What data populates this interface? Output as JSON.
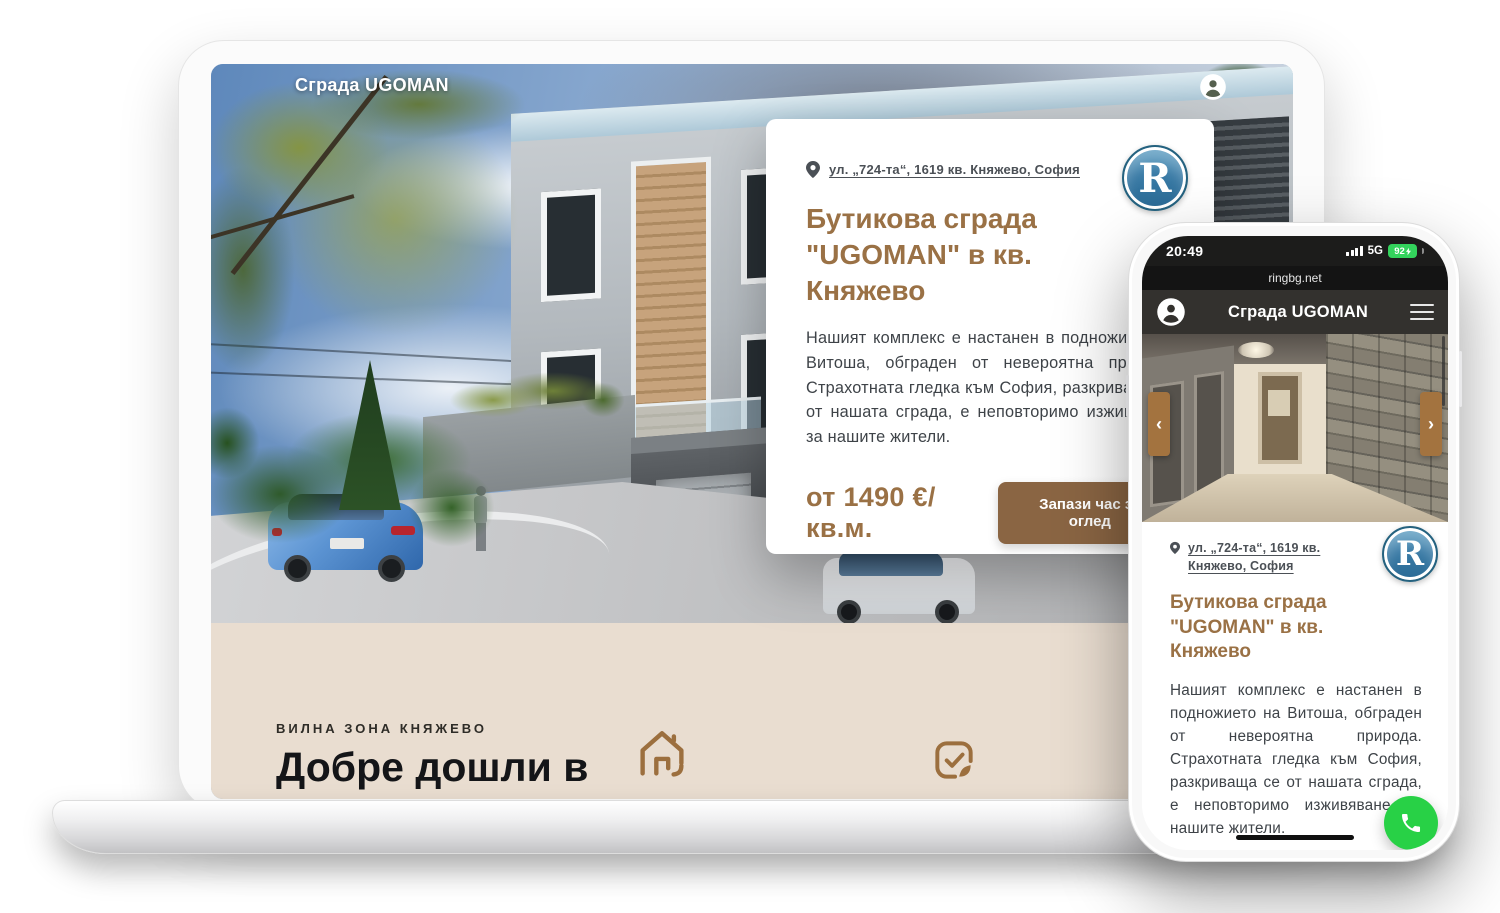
{
  "laptop": {
    "header": {
      "brand": "Сграда UGOMAN"
    },
    "card": {
      "address": "ул. „724-та“, 1619 кв. Княжево, София",
      "logo_letter": "R",
      "title": "Бутикова сграда \"UGOMAN\" в кв. Княжево",
      "description": "Нашият комплекс е настанен в подножието на Витоша, обграден от невероятна природа. Страхотната гледка към София, разкриваща се от нашата сграда, е неповторимо изживяване за нашите жители.",
      "price": "от 1490 €/кв.м.",
      "cta": "Запази час за оглед"
    },
    "welcome": {
      "eyebrow": "ВИЛНА ЗОНА КНЯЖЕВО",
      "title_line1": "Добре дошли в",
      "title_line2": "уютното селище"
    }
  },
  "phone": {
    "status_bar": {
      "time": "20:49",
      "network": "5G",
      "battery_percent": "92"
    },
    "url_bar": {
      "url": "ringbg.net"
    },
    "header": {
      "brand": "Сграда UGOMAN"
    },
    "card": {
      "address": "ул. „724-та“, 1619 кв. Княжево, София",
      "logo_letter": "R",
      "title": "Бутикова сграда \"UGOMAN\" в кв. Княжево",
      "description": "Нашият комплекс е настанен в подножието на Витоша, обграден от невероятна природа. Страхотната гледка към София, разкриваща се от нашата сграда, е неповторимо изживяване за нашите жители."
    }
  },
  "colors": {
    "accent_brown": "#9a7145",
    "button_brown": "#8a6543",
    "arrow_brown": "#a3733f",
    "beige_section": "#e9ddd0",
    "logo_blue": "#3a7ba6",
    "battery_green": "#33d35c",
    "call_green": "#28d146"
  }
}
